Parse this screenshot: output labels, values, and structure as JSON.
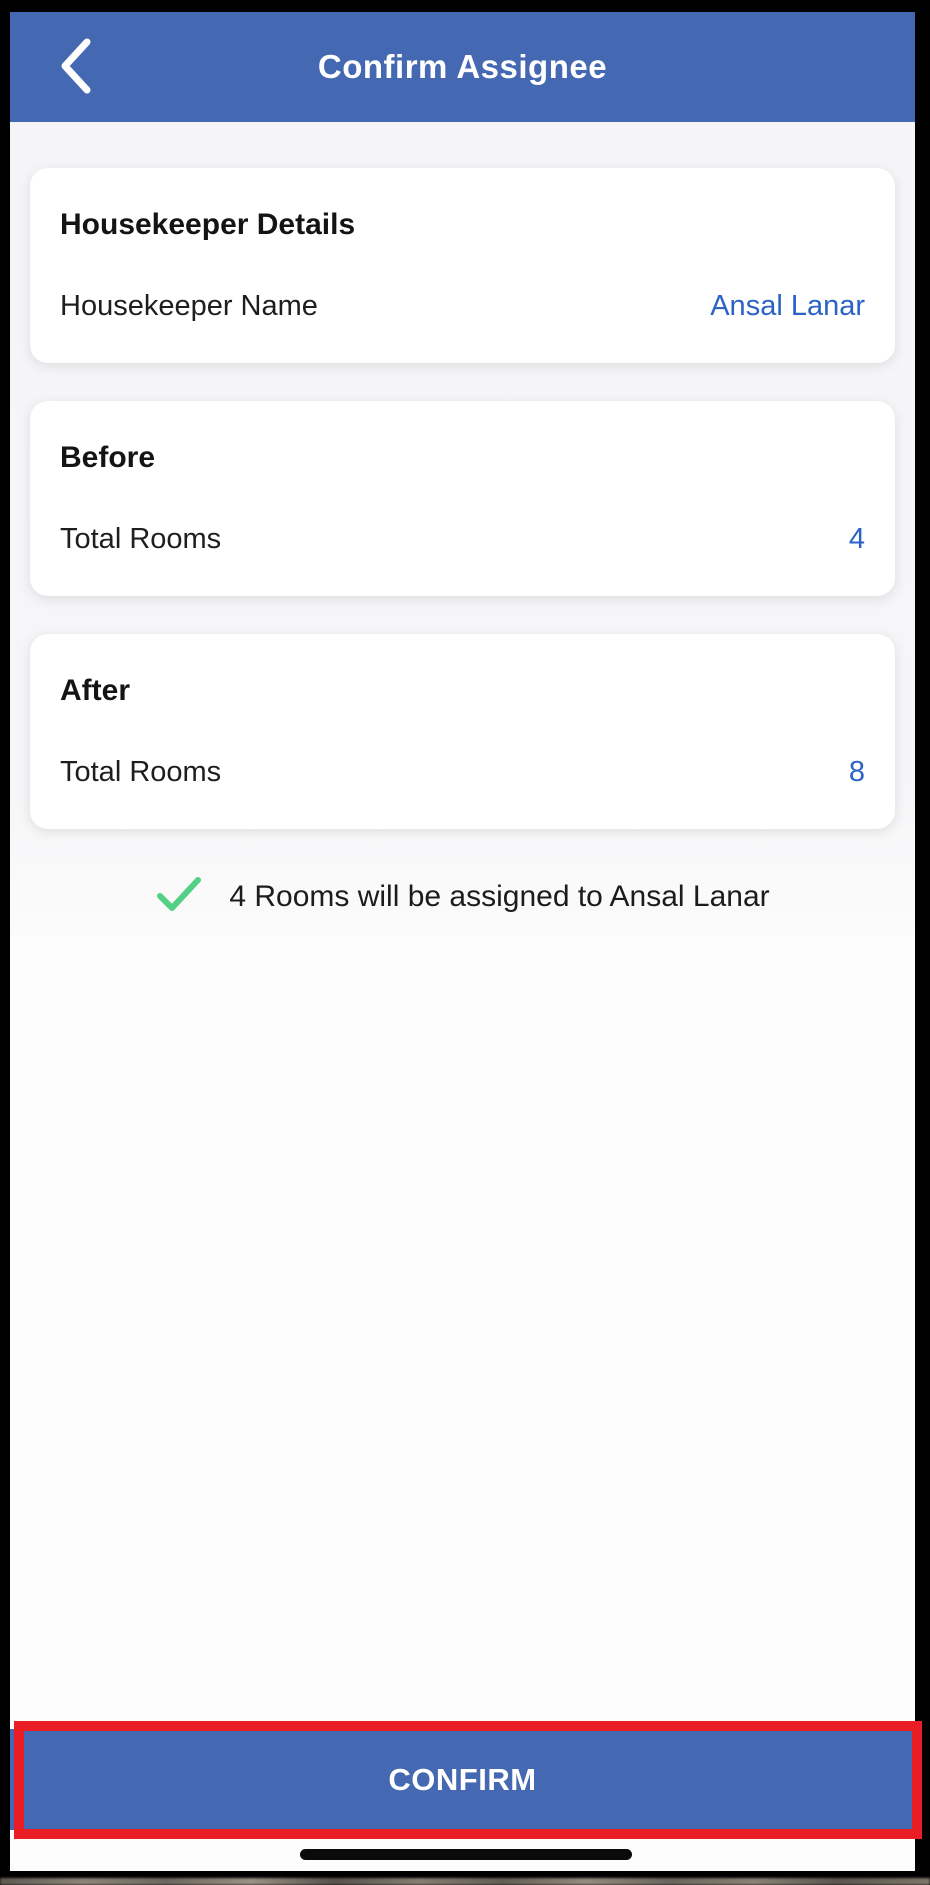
{
  "header": {
    "title": "Confirm Assignee"
  },
  "cards": [
    {
      "title": "Housekeeper Details",
      "rows": [
        {
          "label": "Housekeeper Name",
          "value": "Ansal Lanar"
        }
      ]
    },
    {
      "title": "Before",
      "rows": [
        {
          "label": "Total Rooms",
          "value": "4"
        }
      ]
    },
    {
      "title": "After",
      "rows": [
        {
          "label": "Total Rooms",
          "value": "8"
        }
      ]
    }
  ],
  "confirmation_note": {
    "text": "4 Rooms will be assigned to Ansal Lanar"
  },
  "footer": {
    "confirm_label": "CONFIRM"
  },
  "icons": {
    "back": "chevron-left-icon",
    "note": "checkmark-icon"
  },
  "colors": {
    "header_blue": "#4468b1",
    "button_blue": "#4468b1",
    "link_blue": "#2a62c6",
    "success_green": "#52d186",
    "annotation_red": "#ea1d25",
    "frame_black": "#000000"
  }
}
